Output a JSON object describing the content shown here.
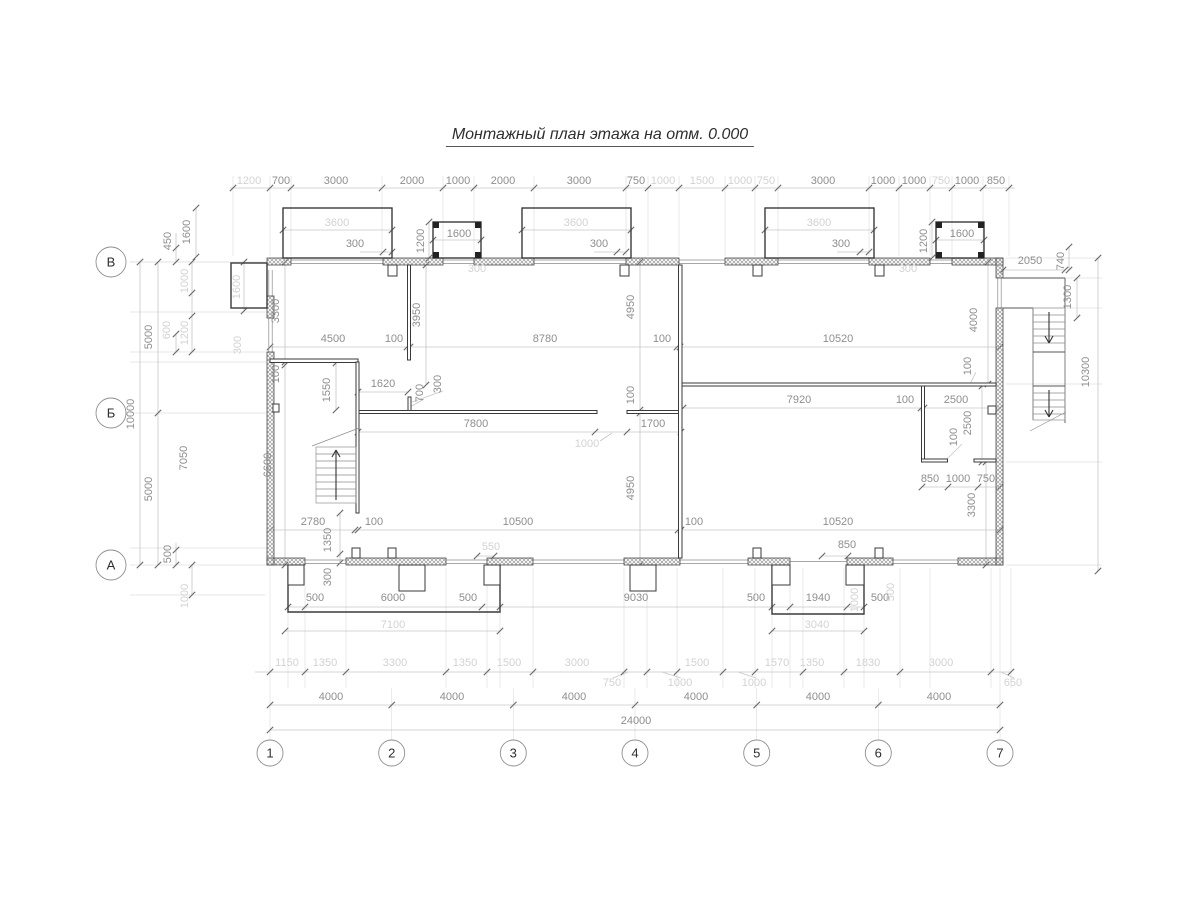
{
  "title": "Монтажный план этажа на отм. 0.000",
  "palette": {
    "walls": "#3a3a3a",
    "hatch": "#9a9a9a",
    "dim_text": "#8e8e8e",
    "dim_text_light": "#d2d2d2",
    "dim_lines": "#c6c6c6",
    "background": "#ffffff"
  },
  "axes": {
    "columns": [
      {
        "label": "1",
        "x": 270
      },
      {
        "label": "2",
        "x": 391.7
      },
      {
        "label": "3",
        "x": 513.3
      },
      {
        "label": "4",
        "x": 635
      },
      {
        "label": "5",
        "x": 756.7
      },
      {
        "label": "6",
        "x": 878.3
      },
      {
        "label": "7",
        "x": 1000
      }
    ],
    "columns_y": 753,
    "rows": [
      {
        "label": "В",
        "y": 262
      },
      {
        "label": "Б",
        "y": 413
      },
      {
        "label": "А",
        "y": 565
      }
    ],
    "rows_x": 111
  },
  "dimensions": [
    [
      "1200",
      249,
      184,
      "l"
    ],
    [
      "700",
      281,
      184,
      ""
    ],
    [
      "3000",
      336,
      184,
      ""
    ],
    [
      "2000",
      412,
      184,
      ""
    ],
    [
      "1000",
      458,
      184,
      ""
    ],
    [
      "2000",
      503,
      184,
      ""
    ],
    [
      "3000",
      579,
      184,
      ""
    ],
    [
      "750",
      636,
      184,
      ""
    ],
    [
      "1000",
      663,
      184,
      "l"
    ],
    [
      "1500",
      702,
      184,
      "l"
    ],
    [
      "1000",
      740,
      184,
      "l"
    ],
    [
      "750",
      766,
      184,
      "l"
    ],
    [
      "3000",
      823,
      184,
      ""
    ],
    [
      "1000",
      883,
      184,
      ""
    ],
    [
      "1000",
      914,
      184,
      ""
    ],
    [
      "750",
      941,
      184,
      "l"
    ],
    [
      "1000",
      967,
      184,
      ""
    ],
    [
      "850",
      996,
      184,
      ""
    ],
    [
      "3600",
      337,
      226,
      "l"
    ],
    [
      "3600",
      576,
      226,
      "l"
    ],
    [
      "3600",
      819,
      226,
      "l"
    ],
    [
      "1600",
      190,
      232,
      "r"
    ],
    [
      "1600",
      459,
      237,
      ""
    ],
    [
      "1600",
      962,
      237,
      ""
    ],
    [
      "1200",
      424,
      241,
      "r"
    ],
    [
      "1200",
      927,
      241,
      "r"
    ],
    [
      "300",
      355,
      247,
      ""
    ],
    [
      "300",
      599,
      247,
      ""
    ],
    [
      "300",
      841,
      247,
      ""
    ],
    [
      "300",
      477,
      272,
      "l"
    ],
    [
      "300",
      908,
      272,
      "l"
    ],
    [
      "450",
      171,
      241,
      "r"
    ],
    [
      "1600",
      240,
      287,
      "rl"
    ],
    [
      "1000",
      188,
      281,
      "rl"
    ],
    [
      "600",
      170,
      330,
      "rl"
    ],
    [
      "1200",
      188,
      333,
      "rl"
    ],
    [
      "5000",
      152,
      337,
      "r"
    ],
    [
      "10000",
      134,
      414,
      "r"
    ],
    [
      "5000",
      152,
      489,
      "r"
    ],
    [
      "7050",
      187,
      458,
      "r"
    ],
    [
      "500",
      171,
      554,
      "r"
    ],
    [
      "1000",
      188,
      596,
      "rl"
    ],
    [
      "3300",
      279,
      311,
      "r"
    ],
    [
      "300",
      241,
      345,
      "rl"
    ],
    [
      "100",
      279,
      374,
      "r"
    ],
    [
      "6600",
      271,
      465,
      "r"
    ],
    [
      "4500",
      333,
      342,
      ""
    ],
    [
      "100",
      394,
      342,
      ""
    ],
    [
      "8780",
      545,
      342,
      ""
    ],
    [
      "100",
      662,
      342,
      ""
    ],
    [
      "10520",
      838,
      342,
      ""
    ],
    [
      "3950",
      420,
      315,
      "r"
    ],
    [
      "4950",
      634,
      307,
      "r"
    ],
    [
      "100",
      634,
      395,
      "r"
    ],
    [
      "4950",
      634,
      488,
      "r"
    ],
    [
      "1550",
      330,
      390,
      "r"
    ],
    [
      "1620",
      383,
      387,
      ""
    ],
    [
      "700",
      423,
      393,
      "r"
    ],
    [
      "300",
      441,
      384,
      "r"
    ],
    [
      "7800",
      476,
      427,
      ""
    ],
    [
      "1000",
      587,
      447,
      "l"
    ],
    [
      "1700",
      653,
      427,
      ""
    ],
    [
      "7920",
      799,
      403,
      ""
    ],
    [
      "100",
      905,
      403,
      ""
    ],
    [
      "2500",
      956,
      403,
      ""
    ],
    [
      "100",
      957,
      437,
      "r"
    ],
    [
      "2500",
      971,
      423,
      "r"
    ],
    [
      "100",
      971,
      366,
      "r"
    ],
    [
      "850",
      930,
      482,
      ""
    ],
    [
      "1000",
      958,
      482,
      ""
    ],
    [
      "750",
      986,
      482,
      ""
    ],
    [
      "3300",
      975,
      505,
      "r"
    ],
    [
      "4000",
      977,
      320,
      "r"
    ],
    [
      "2780",
      313,
      525,
      ""
    ],
    [
      "100",
      374,
      525,
      ""
    ],
    [
      "10500",
      518,
      525,
      ""
    ],
    [
      "100",
      694,
      525,
      ""
    ],
    [
      "10520",
      838,
      525,
      ""
    ],
    [
      "1350",
      331,
      540,
      "r"
    ],
    [
      "300",
      331,
      577,
      "r"
    ],
    [
      "550",
      491,
      550,
      "l"
    ],
    [
      "850",
      847,
      548,
      ""
    ],
    [
      "2050",
      1030,
      264,
      ""
    ],
    [
      "740",
      1064,
      261,
      "r"
    ],
    [
      "1300",
      1071,
      297,
      "r"
    ],
    [
      "10300",
      1089,
      372,
      "r"
    ],
    [
      "500",
      315,
      601,
      ""
    ],
    [
      "6000",
      393,
      601,
      ""
    ],
    [
      "500",
      468,
      601,
      ""
    ],
    [
      "9030",
      636,
      601,
      ""
    ],
    [
      "500",
      756,
      601,
      ""
    ],
    [
      "1940",
      818,
      601,
      ""
    ],
    [
      "500",
      880,
      601,
      ""
    ],
    [
      "7100",
      393,
      628,
      "l"
    ],
    [
      "3040",
      817,
      628,
      "l"
    ],
    [
      "1000",
      858,
      600,
      "rl"
    ],
    [
      "500",
      894,
      592,
      "rl"
    ],
    [
      "1150",
      287,
      666,
      "l"
    ],
    [
      "1350",
      325,
      666,
      "l"
    ],
    [
      "3300",
      395,
      666,
      "l"
    ],
    [
      "1350",
      465,
      666,
      "l"
    ],
    [
      "1500",
      509,
      666,
      "l"
    ],
    [
      "3000",
      577,
      666,
      "l"
    ],
    [
      "750",
      612,
      686,
      "l"
    ],
    [
      "1000",
      680,
      686,
      "l"
    ],
    [
      "1500",
      697,
      666,
      "l"
    ],
    [
      "1000",
      754,
      686,
      "l"
    ],
    [
      "1570",
      777,
      666,
      "l"
    ],
    [
      "1350",
      812,
      666,
      "l"
    ],
    [
      "1830",
      868,
      666,
      "l"
    ],
    [
      "3000",
      941,
      666,
      "l"
    ],
    [
      "650",
      1013,
      686,
      "l"
    ],
    [
      "4000",
      331,
      700,
      ""
    ],
    [
      "4000",
      452,
      700,
      ""
    ],
    [
      "4000",
      574,
      700,
      ""
    ],
    [
      "4000",
      696,
      700,
      ""
    ],
    [
      "4000",
      818,
      700,
      ""
    ],
    [
      "4000",
      939,
      700,
      ""
    ],
    [
      "24000",
      636,
      724,
      ""
    ]
  ]
}
